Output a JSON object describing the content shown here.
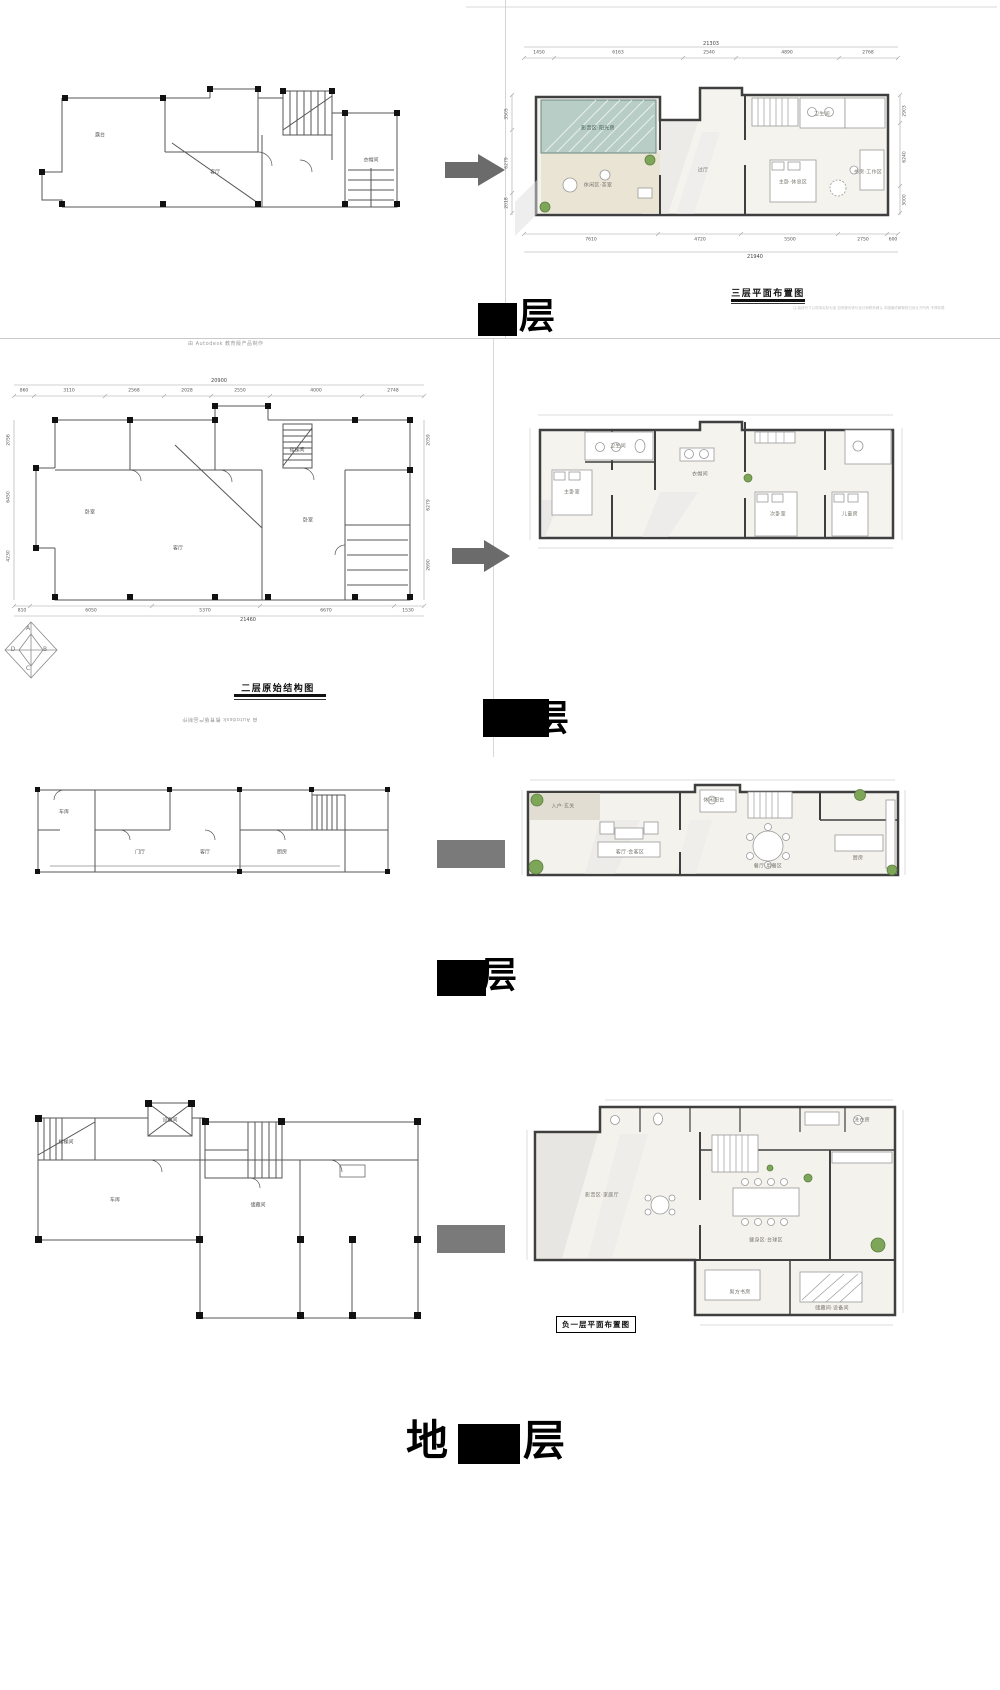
{
  "colors": {
    "teal_glass": "#b7cdc6",
    "wall": "#3f3f3f",
    "arrow": "#6b6b6b",
    "plant": "#7da659",
    "shadow": "#dcdcdc"
  },
  "s1": {
    "plan_title": "三层平面布置图",
    "floor_big": {
      "suffix": "层"
    },
    "autodesk": "由 Autodesk 教育版产品制作",
    "note": "注:装修尺寸以现场实际为准 如有疑问请与设计师联系确认 本图最终解释权归设计方所有 不得转载",
    "dims": {
      "top_total": "21303",
      "top": [
        "1450",
        "6163",
        "2540",
        "4890",
        "2768"
      ],
      "bottom": [
        "7610",
        "4720",
        "5500",
        "2750",
        "600"
      ],
      "bottom_total": "21940",
      "left": [
        "3505",
        "6279",
        "2018"
      ],
      "right": [
        "2903",
        "6240",
        "3000"
      ]
    },
    "cad_rooms": [
      "露台",
      "客厅",
      "衣帽间"
    ],
    "rooms": [
      "影音区·阳光房",
      "休闲区·茶室",
      "过厅",
      "卫生间",
      "主卧·休息区",
      "书房·工作区"
    ]
  },
  "s2": {
    "plan_label": "二层原始结构图",
    "floor_big": {
      "suffix": "层"
    },
    "autodesk": "由 Autodesk 教育版产品制作",
    "dims": {
      "top_total": "20900",
      "top": [
        "860",
        "3110",
        "2568",
        "2028",
        "2550",
        "4000",
        "2748"
      ],
      "bottom": [
        "810",
        "6050",
        "5370",
        "6670",
        "1530"
      ],
      "bottom_total": "21460",
      "left": [
        "2056",
        "6450",
        "4230"
      ],
      "right": [
        "2059",
        "6279",
        "2690"
      ]
    },
    "cad_rooms": [
      "卧室",
      "客厅",
      "卧室",
      "楼梯间"
    ],
    "rooms": [
      "主卧室",
      "卫生间",
      "衣帽间",
      "次卧室",
      "儿童房"
    ]
  },
  "s3": {
    "floor_big": {
      "suffix": "层"
    },
    "cad_rooms": [
      "车库",
      "门厅",
      "客厅",
      "厨房"
    ],
    "rooms": [
      "入户·玄关",
      "客厅·会客区",
      "餐厅·用餐区",
      "厨房",
      "休闲阳台"
    ]
  },
  "s4": {
    "plan_label": "负一层平面布置图",
    "floor_big": {
      "prefix": "地",
      "suffix": "层"
    },
    "cad_rooms": [
      "楼梯间",
      "设备间",
      "车库",
      "储藏间"
    ],
    "rooms": [
      "影音区·家庭厅",
      "健身区·台球区",
      "男方书房",
      "储藏间·设备间",
      "洗衣房"
    ]
  },
  "logo": {
    "letters": [
      "A",
      "D",
      "B",
      "C"
    ]
  }
}
